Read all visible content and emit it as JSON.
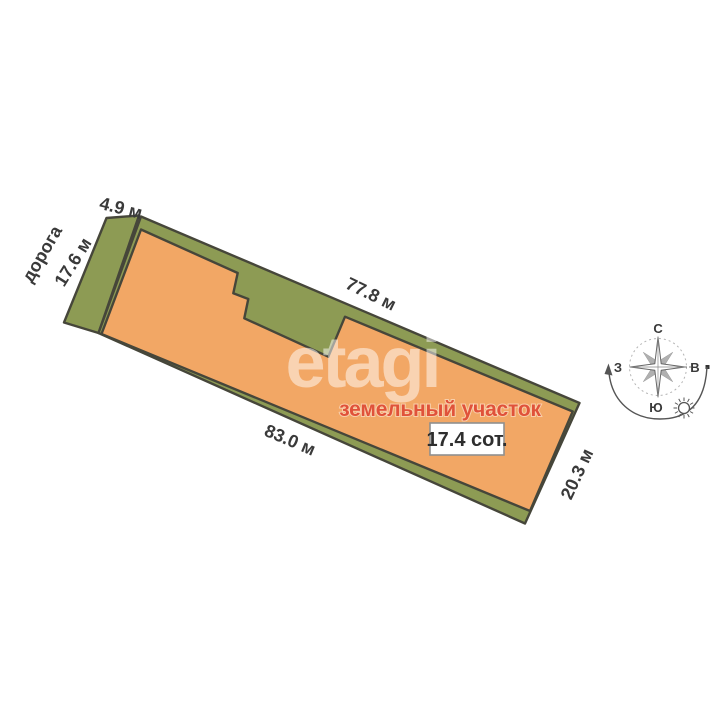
{
  "plot": {
    "title": "земельный участок",
    "area_label": "17.4 сот.",
    "road_label": "дорога",
    "dimensions": {
      "top_left": "4.9 м",
      "left": "17.6 м",
      "top": "77.8 м",
      "bottom": "83.0 м",
      "right": "20.3 м"
    },
    "colors": {
      "green": "#8d9b54",
      "orange": "#f2a765",
      "outline": "#46463a",
      "label": "#3a3a3a",
      "title_color": "#e0523a"
    }
  },
  "compass": {
    "north": "С",
    "south": "Ю",
    "west": "З",
    "east": "В"
  },
  "watermark": {
    "text": "etagi"
  }
}
